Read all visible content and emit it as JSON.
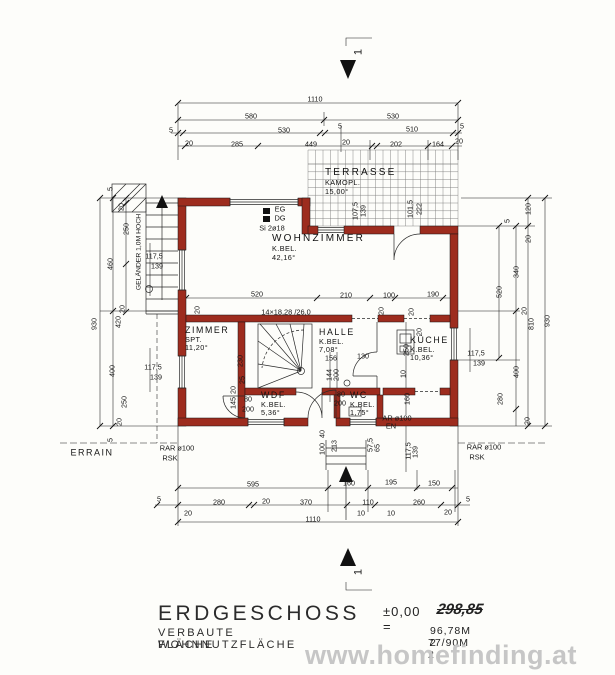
{
  "colors": {
    "wall": "#9d2c1e",
    "line": "#1c1c1c",
    "watermark": "#c6c6c6"
  },
  "watermark": {
    "text": "www.homefinding.at"
  },
  "title_block": {
    "title": "ERDGESCHOSS",
    "row1_label": "VERBAUTE FLÄCHE",
    "row2_label": "WOHNNUTZFLÄCHE",
    "elevation_label": "±0,00 =",
    "elevation_value": "298,85",
    "built_area_value": "96,78M 2",
    "living_area_value": "77/90M 2"
  },
  "rooms": [
    {
      "x": 325,
      "y": 167,
      "big": true,
      "lines": [
        "TERRASSE",
        "KAMOPL.",
        "15,00°"
      ]
    },
    {
      "x": 272,
      "y": 233,
      "big": true,
      "lines": [
        "WOHNZIMMER",
        "K.BEL.",
        "42,16°"
      ]
    },
    {
      "x": 185,
      "y": 325,
      "lines": [
        "ZIMMER",
        "SPT.",
        "11,20°"
      ]
    },
    {
      "x": 319,
      "y": 327,
      "lines": [
        "HALLE",
        "K.BEL.",
        "7,08°"
      ]
    },
    {
      "x": 410,
      "y": 335,
      "lines": [
        "KÜCHE",
        "K.BEL.",
        "10,36°"
      ]
    },
    {
      "x": 261,
      "y": 390,
      "lines": [
        "WDF",
        "K.BEL.",
        "5,36°"
      ]
    },
    {
      "x": 350,
      "y": 390,
      "lines": [
        "WC",
        "K.BEL.",
        "1,75°"
      ]
    }
  ],
  "annotations": [
    {
      "t": "EG",
      "x": 280,
      "y": 209
    },
    {
      "t": "DG",
      "x": 280,
      "y": 218
    },
    {
      "t": "Si 2ø18",
      "x": 272,
      "y": 228
    },
    {
      "t": "14×18,28 /26,0",
      "x": 286,
      "y": 312
    },
    {
      "t": "GELÄNDER 1,0M HOCH",
      "x": 140,
      "y": 252,
      "r": -90,
      "s": 6.8
    },
    {
      "t": "ERRAIN",
      "x": 92,
      "y": 453,
      "s": 9,
      "sp": 1.5
    },
    {
      "t": "RAR ø100",
      "x": 177,
      "y": 448
    },
    {
      "t": "RSK",
      "x": 170,
      "y": 458
    },
    {
      "t": "RAR ø100",
      "x": 484,
      "y": 447
    },
    {
      "t": "RSK",
      "x": 477,
      "y": 457
    },
    {
      "t": "AR ø100",
      "x": 397,
      "y": 418
    },
    {
      "t": "EN",
      "x": 391,
      "y": 426
    },
    {
      "t": "1",
      "x": 359,
      "y": 52,
      "r": -90,
      "s": 11,
      "n": "section-mark-label"
    },
    {
      "t": "1",
      "x": 359,
      "y": 572,
      "r": -90,
      "s": 11,
      "n": "section-mark-label"
    }
  ],
  "dimensions": [
    {
      "t": "1110",
      "x": 315,
      "y": 99
    },
    {
      "t": "580",
      "x": 251,
      "y": 116
    },
    {
      "t": "530",
      "x": 393,
      "y": 116
    },
    {
      "t": "5",
      "x": 171,
      "y": 130
    },
    {
      "t": "530",
      "x": 284,
      "y": 130
    },
    {
      "t": "5",
      "x": 340,
      "y": 126
    },
    {
      "t": "510",
      "x": 412,
      "y": 129
    },
    {
      "t": "5",
      "x": 462,
      "y": 126
    },
    {
      "t": "20",
      "x": 189,
      "y": 143
    },
    {
      "t": "285",
      "x": 237,
      "y": 144
    },
    {
      "t": "449",
      "x": 311,
      "y": 144
    },
    {
      "t": "20",
      "x": 346,
      "y": 142
    },
    {
      "t": "202",
      "x": 396,
      "y": 144
    },
    {
      "t": "164",
      "x": 438,
      "y": 144
    },
    {
      "t": "20",
      "x": 459,
      "y": 141
    },
    {
      "t": "107,5",
      "x": 355,
      "y": 211,
      "r": -90
    },
    {
      "t": "139",
      "x": 363,
      "y": 211,
      "r": -90
    },
    {
      "t": "101,5",
      "x": 410,
      "y": 209,
      "r": -90
    },
    {
      "t": "222",
      "x": 419,
      "y": 209,
      "r": -90
    },
    {
      "t": "520",
      "x": 257,
      "y": 294
    },
    {
      "t": "210",
      "x": 346,
      "y": 295
    },
    {
      "t": "100",
      "x": 389,
      "y": 295
    },
    {
      "t": "190",
      "x": 433,
      "y": 294
    },
    {
      "t": "20",
      "x": 197,
      "y": 310,
      "r": -90
    },
    {
      "t": "20",
      "x": 381,
      "y": 311,
      "r": -90
    },
    {
      "t": "20",
      "x": 411,
      "y": 312,
      "r": -90
    },
    {
      "t": "5",
      "x": 110,
      "y": 189,
      "r": -90
    },
    {
      "t": "20",
      "x": 121,
      "y": 207,
      "r": -90
    },
    {
      "t": "250",
      "x": 126,
      "y": 229,
      "r": -90
    },
    {
      "t": "460",
      "x": 110,
      "y": 264,
      "r": -90
    },
    {
      "t": "20",
      "x": 122,
      "y": 309,
      "r": -90
    },
    {
      "t": "420",
      "x": 118,
      "y": 322,
      "r": -90
    },
    {
      "t": "930",
      "x": 94,
      "y": 324,
      "r": -90
    },
    {
      "t": "400",
      "x": 112,
      "y": 371,
      "r": -90
    },
    {
      "t": "250",
      "x": 124,
      "y": 402,
      "r": -90
    },
    {
      "t": "20",
      "x": 119,
      "y": 422,
      "r": -90
    },
    {
      "t": "5",
      "x": 110,
      "y": 440,
      "r": -90
    },
    {
      "t": "117,5",
      "x": 154,
      "y": 256
    },
    {
      "t": "139",
      "x": 157,
      "y": 266
    },
    {
      "t": "117,5",
      "x": 153,
      "y": 367
    },
    {
      "t": "139",
      "x": 156,
      "y": 377
    },
    {
      "t": "120",
      "x": 528,
      "y": 209,
      "r": -90
    },
    {
      "t": "5",
      "x": 507,
      "y": 221,
      "r": -90
    },
    {
      "t": "20",
      "x": 528,
      "y": 239,
      "r": -90
    },
    {
      "t": "340",
      "x": 516,
      "y": 272,
      "r": -90
    },
    {
      "t": "520",
      "x": 499,
      "y": 292,
      "r": -90
    },
    {
      "t": "20",
      "x": 524,
      "y": 311,
      "r": -90
    },
    {
      "t": "810",
      "x": 531,
      "y": 324,
      "r": -90
    },
    {
      "t": "930",
      "x": 547,
      "y": 321,
      "r": -90
    },
    {
      "t": "117,5",
      "x": 476,
      "y": 353
    },
    {
      "t": "139",
      "x": 479,
      "y": 363
    },
    {
      "t": "400",
      "x": 516,
      "y": 372,
      "r": -90
    },
    {
      "t": "280",
      "x": 500,
      "y": 399,
      "r": -90
    },
    {
      "t": "20",
      "x": 527,
      "y": 421,
      "r": -90
    },
    {
      "t": "230",
      "x": 240,
      "y": 361,
      "r": -90
    },
    {
      "t": "25",
      "x": 242,
      "y": 380,
      "r": -90
    },
    {
      "t": "156",
      "x": 331,
      "y": 358
    },
    {
      "t": "144",
      "x": 329,
      "y": 375,
      "r": -90
    },
    {
      "t": "200",
      "x": 336,
      "y": 375,
      "r": -90
    },
    {
      "t": "130",
      "x": 363,
      "y": 356
    },
    {
      "t": "20",
      "x": 419,
      "y": 332,
      "r": -90
    },
    {
      "t": "250",
      "x": 406,
      "y": 350,
      "r": -90
    },
    {
      "t": "10",
      "x": 403,
      "y": 374,
      "r": -90
    },
    {
      "t": "160",
      "x": 407,
      "y": 399,
      "r": -90
    },
    {
      "t": "80",
      "x": 248,
      "y": 399
    },
    {
      "t": "200",
      "x": 248,
      "y": 409
    },
    {
      "t": "20",
      "x": 233,
      "y": 390,
      "r": -90
    },
    {
      "t": "145",
      "x": 233,
      "y": 403,
      "r": -90
    },
    {
      "t": "80",
      "x": 341,
      "y": 394
    },
    {
      "t": "200",
      "x": 340,
      "y": 403
    },
    {
      "t": "100",
      "x": 322,
      "y": 449,
      "r": -90
    },
    {
      "t": "40",
      "x": 322,
      "y": 434,
      "r": -90
    },
    {
      "t": "213",
      "x": 334,
      "y": 446,
      "r": -90
    },
    {
      "t": "57,5",
      "x": 370,
      "y": 445,
      "r": -90
    },
    {
      "t": "65",
      "x": 377,
      "y": 448,
      "r": -90
    },
    {
      "t": "117,5",
      "x": 408,
      "y": 451,
      "r": -90
    },
    {
      "t": "139",
      "x": 415,
      "y": 452,
      "r": -90
    },
    {
      "t": "595",
      "x": 253,
      "y": 484
    },
    {
      "t": "160",
      "x": 349,
      "y": 483
    },
    {
      "t": "195",
      "x": 391,
      "y": 482
    },
    {
      "t": "150",
      "x": 434,
      "y": 483
    },
    {
      "t": "5",
      "x": 159,
      "y": 499
    },
    {
      "t": "280",
      "x": 219,
      "y": 502
    },
    {
      "t": "20",
      "x": 266,
      "y": 501
    },
    {
      "t": "370",
      "x": 306,
      "y": 502
    },
    {
      "t": "110",
      "x": 368,
      "y": 502
    },
    {
      "t": "260",
      "x": 419,
      "y": 502
    },
    {
      "t": "5",
      "x": 468,
      "y": 499
    },
    {
      "t": "20",
      "x": 188,
      "y": 513
    },
    {
      "t": "10",
      "x": 361,
      "y": 513
    },
    {
      "t": "10",
      "x": 391,
      "y": 513
    },
    {
      "t": "20",
      "x": 448,
      "y": 512
    },
    {
      "t": "1110",
      "x": 313,
      "y": 519
    }
  ]
}
